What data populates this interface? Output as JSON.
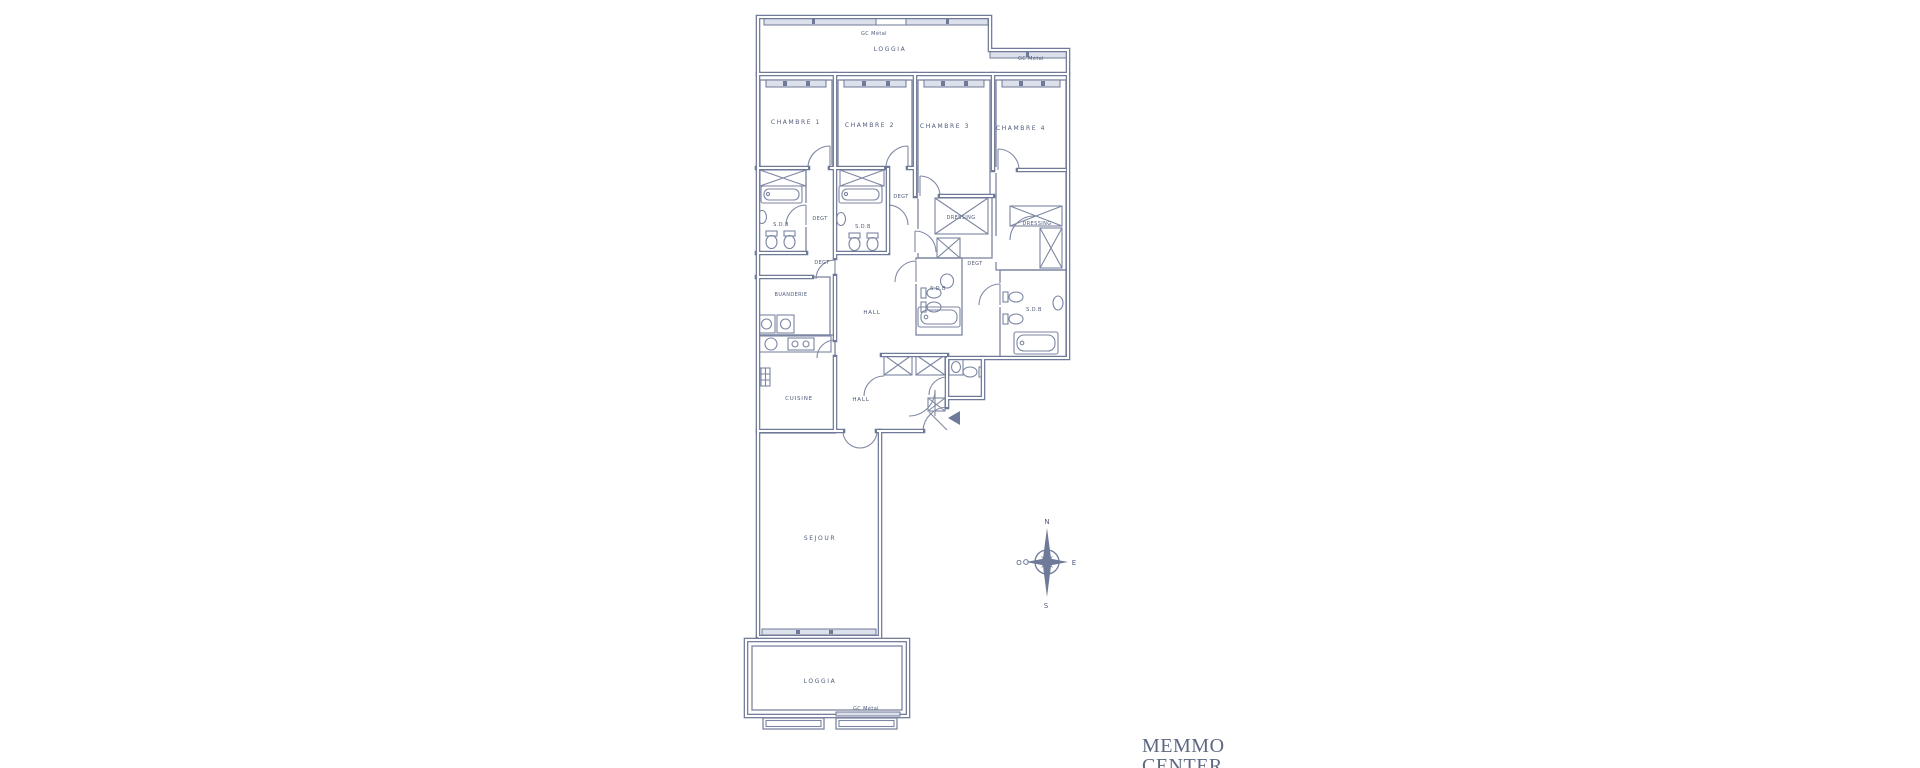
{
  "document": {
    "type": "apartment-floor-plan-scan",
    "background": "#ffffff"
  },
  "colors": {
    "wall": "#6f7a98",
    "wall_light": "#7c86a2",
    "window_band": "#dce0ea",
    "label_text": "#4e5a79",
    "brand_text": "#5d6880"
  },
  "labels": {
    "loggia_top": "LOGGIA",
    "gc_metal_top_left": "GC Métal",
    "gc_metal_top_right": "GC Métal",
    "gc_metal_bottom": "GC Métal",
    "chambre_1": "CHAMBRE 1",
    "chambre_2": "CHAMBRE 2",
    "chambre_3": "CHAMBRE 3",
    "chambre_4": "CHAMBRE 4",
    "sdb_1": "S.D.B",
    "sdb_2": "S.D.B",
    "sdb_3": "S.D.B",
    "sdb_4": "S.D.B",
    "degt_1": "DEGT",
    "degt_2": "DEGT",
    "degt_3": "DEGT",
    "degt_4": "DEGT",
    "dressing_1": "DRESSING",
    "dressing_2": "DRESSING",
    "buanderie": "BUANDERIE",
    "hall_upper": "HALL",
    "hall_entrance": "HALL",
    "cuisine": "CUISINE",
    "sejour": "SEJOUR",
    "loggia_bottom": "LOGGIA"
  },
  "compass": {
    "north": "N",
    "south": "S",
    "east": "E",
    "west": "O"
  },
  "brand": {
    "line1": "MEMMO",
    "line2": "CENTER"
  }
}
